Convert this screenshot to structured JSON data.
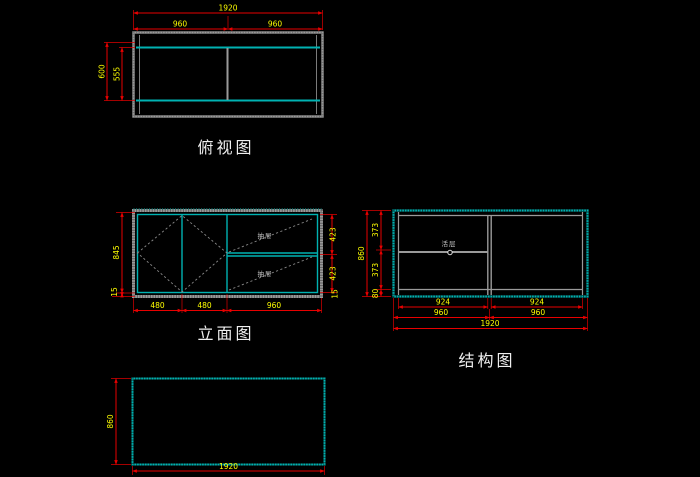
{
  "drawing": {
    "views": {
      "top_view": {
        "title": "俯视图",
        "dims": {
          "overall_width": "1920",
          "left_half": "960",
          "right_half": "960",
          "outer_depth": "600",
          "inner_depth": "555"
        }
      },
      "elevation_view": {
        "title": "立面图",
        "dims": {
          "body_height": "845",
          "base_height_left": "15",
          "base_height_right": "15",
          "door_left": "480",
          "door_right": "480",
          "drawer_section_width": "960",
          "drawer_top_height": "423",
          "drawer_bottom_height": "423"
        },
        "annotations": {
          "drawer_top": "抽屉",
          "drawer_bottom": "抽屉"
        }
      },
      "structure_view": {
        "title": "结构图",
        "dims": {
          "overall_height": "860",
          "upper_section": "373",
          "lower_section": "373",
          "base_section": "80",
          "left_clear_width": "924",
          "right_clear_width": "924",
          "left_half": "960",
          "right_half": "960",
          "overall_width": "1920"
        },
        "annotations": {
          "shelf": "活层"
        }
      },
      "panel_view": {
        "dims": {
          "height": "860",
          "width": "1920"
        }
      }
    },
    "colors": {
      "background": "#000000",
      "dimension_line": "#e80000",
      "dimension_text": "#ffff00",
      "outline_cyan": "#00b2b2",
      "outline_gray": "#9a9a9a",
      "title_text": "#efefef"
    }
  }
}
